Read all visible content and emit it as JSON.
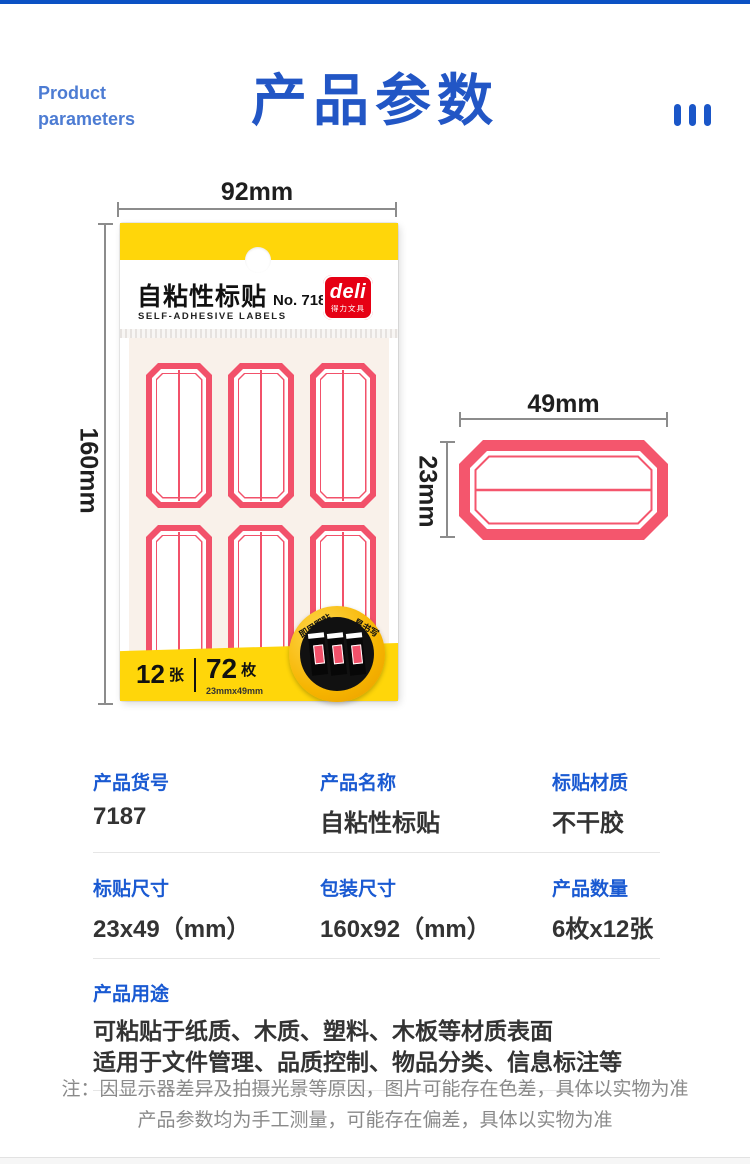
{
  "header": {
    "eyebrow_line1": "Product",
    "eyebrow_line2": "parameters",
    "title": "产品参数"
  },
  "package": {
    "dim_width": "92mm",
    "dim_height": "160mm",
    "name": "自粘性标贴",
    "model": "No. 7187",
    "name_en": "SELF-ADHESIVE LABELS",
    "brand": "deli",
    "brand_cn": "得力文具",
    "sheets_value": "12",
    "sheets_unit": "张",
    "pieces_value": "72",
    "pieces_unit": "枚",
    "pieces_spec": "23mmx49mm",
    "badge_text_left": "即用即贴",
    "badge_text_right": "易书写"
  },
  "label": {
    "dim_width": "49mm",
    "dim_height": "23mm"
  },
  "specs": {
    "row1": [
      {
        "label": "产品货号",
        "value": "7187"
      },
      {
        "label": "产品名称",
        "value": "自粘性标贴"
      },
      {
        "label": "标贴材质",
        "value": "不干胶"
      }
    ],
    "row2": [
      {
        "label": "标贴尺寸",
        "value": "23x49（mm）"
      },
      {
        "label": "包装尺寸",
        "value": "160x92（mm）"
      },
      {
        "label": "产品数量",
        "value": "6枚x12张"
      }
    ],
    "usage_label": "产品用途",
    "usage_line1": "可粘贴于纸质、木质、塑料、木板等材质表面",
    "usage_line2": "适用于文件管理、品质控制、物品分类、信息标注等"
  },
  "footnote": {
    "line1": "注：因显示器差异及拍摄光景等原因，图片可能存在色差，具体以实物为准",
    "line2": "产品参数均为手工测量，可能存在偏差，具体以实物为准"
  },
  "colors": {
    "accent_blue": "#1d57c8",
    "label_red": "#f2516a",
    "package_yellow": "#ffd60a",
    "deli_red": "#e60014"
  }
}
